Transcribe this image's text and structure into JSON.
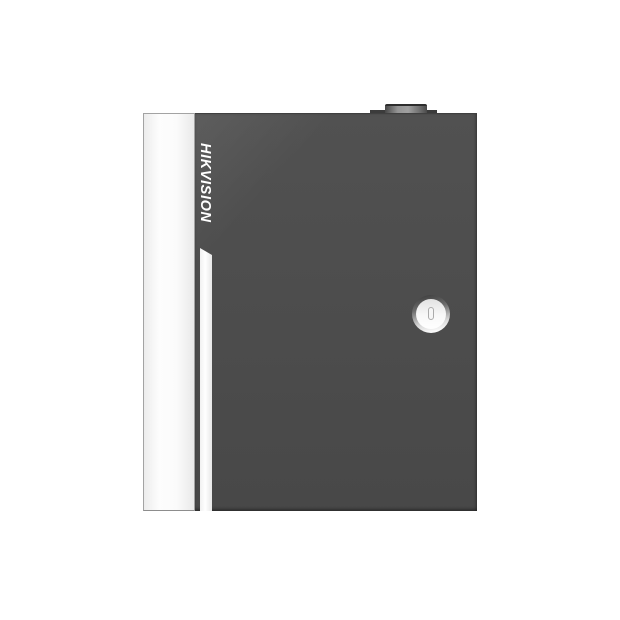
{
  "product": {
    "brand": "HIKVISION"
  },
  "elements": {
    "side_panel": "white-side-panel",
    "front_door": "dark-gray-front-door",
    "accent_stripe": "white-accent-stripe",
    "hinge": "top-hinge-block",
    "lock": "circular-cam-lock",
    "keyhole": "vertical-keyhole"
  },
  "colors": {
    "background": "#ffffff",
    "door": "#4d4d4d",
    "panel": "#fbfbfb",
    "panel-border": "#a3a3a3",
    "stripe": "#ffffff",
    "brand-text": "#ffffff",
    "hinge": "#3b3b3b",
    "hinge-highlight": "#949494",
    "lock-face": "#ffffff",
    "keyhole": "#ababab"
  }
}
